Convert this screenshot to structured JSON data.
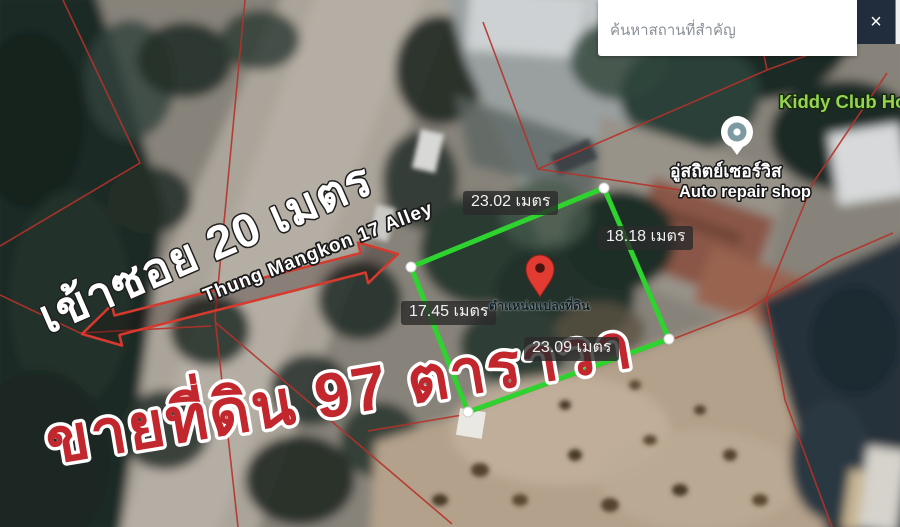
{
  "search": {
    "placeholder": "ค้นหาสถานที่สำคัญ",
    "clear": "×"
  },
  "poi": {
    "kiddy_club": "Kiddy Club Ho",
    "auto_repair_name": "อู่สถิตย์เซอร์วิส",
    "auto_repair_type": "Auto repair shop"
  },
  "measurements": {
    "top": "23.02 เมตร",
    "right": "18.18 เมตร",
    "left": "17.45 เมตร",
    "bottom": "23.09 เมตร"
  },
  "plot_marker": {
    "caption": "ตำแหน่งแปลงที่ดิน"
  },
  "annotations": {
    "alley_entry": "เข้าซอย 20 เมตร",
    "alley_name": "Thung Mangkon 17 Alley",
    "sale_text": "ขายที่ดิน 97 ตาราวา"
  },
  "colors": {
    "plot_outline": "#2fd32f",
    "parcel_boundary": "#b5322a",
    "sale_text": "#c1272d",
    "kiddy_text": "#94d44f",
    "pin": "#e23b32",
    "search_button_bg": "#212d3d"
  }
}
